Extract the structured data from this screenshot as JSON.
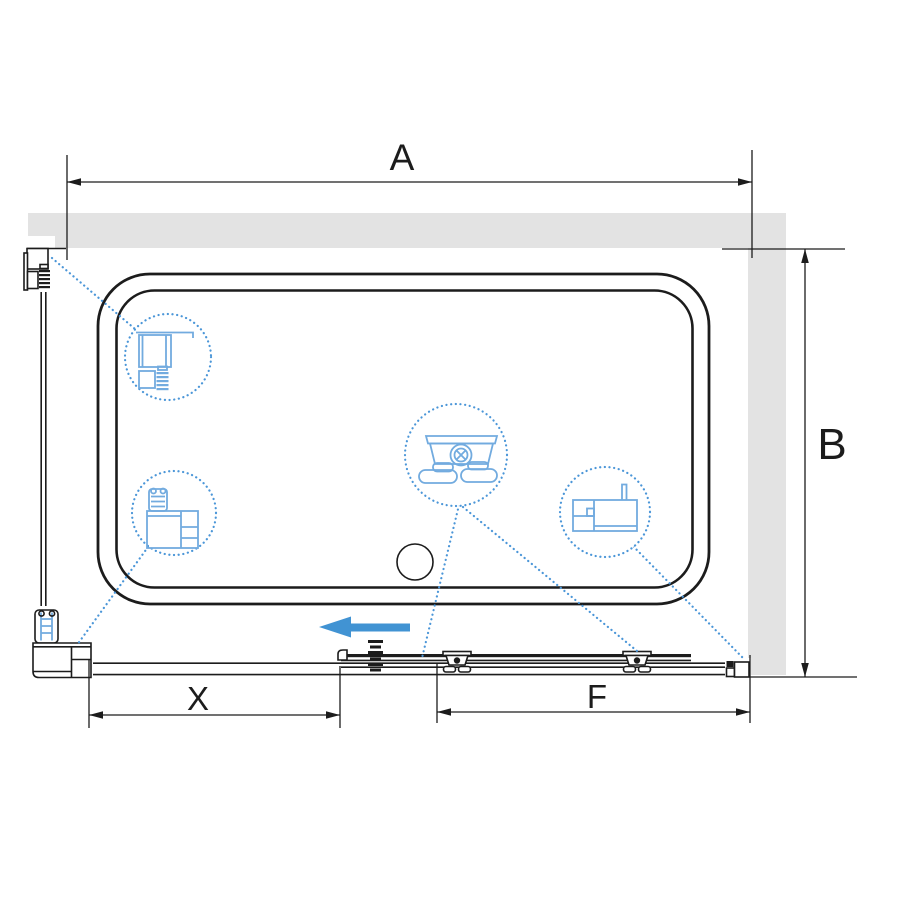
{
  "labels": {
    "width_top": "A",
    "depth_right": "B",
    "width_fixed": "X",
    "width_door": "F"
  },
  "colors": {
    "wall": "#e3e3e3",
    "line": "#1c1c1c",
    "blue": "#4b96d8",
    "blue_light": "#72abdf",
    "accent": "#4193d3",
    "bg": "#ffffff"
  },
  "icons": {
    "slide_direction": "arrow-left",
    "detail_top_left": "wall-profile-cross-section",
    "detail_bottom_left": "corner-profile-cross-section",
    "detail_center": "roller-carriage",
    "detail_right": "bottom-rail-cross-section"
  }
}
